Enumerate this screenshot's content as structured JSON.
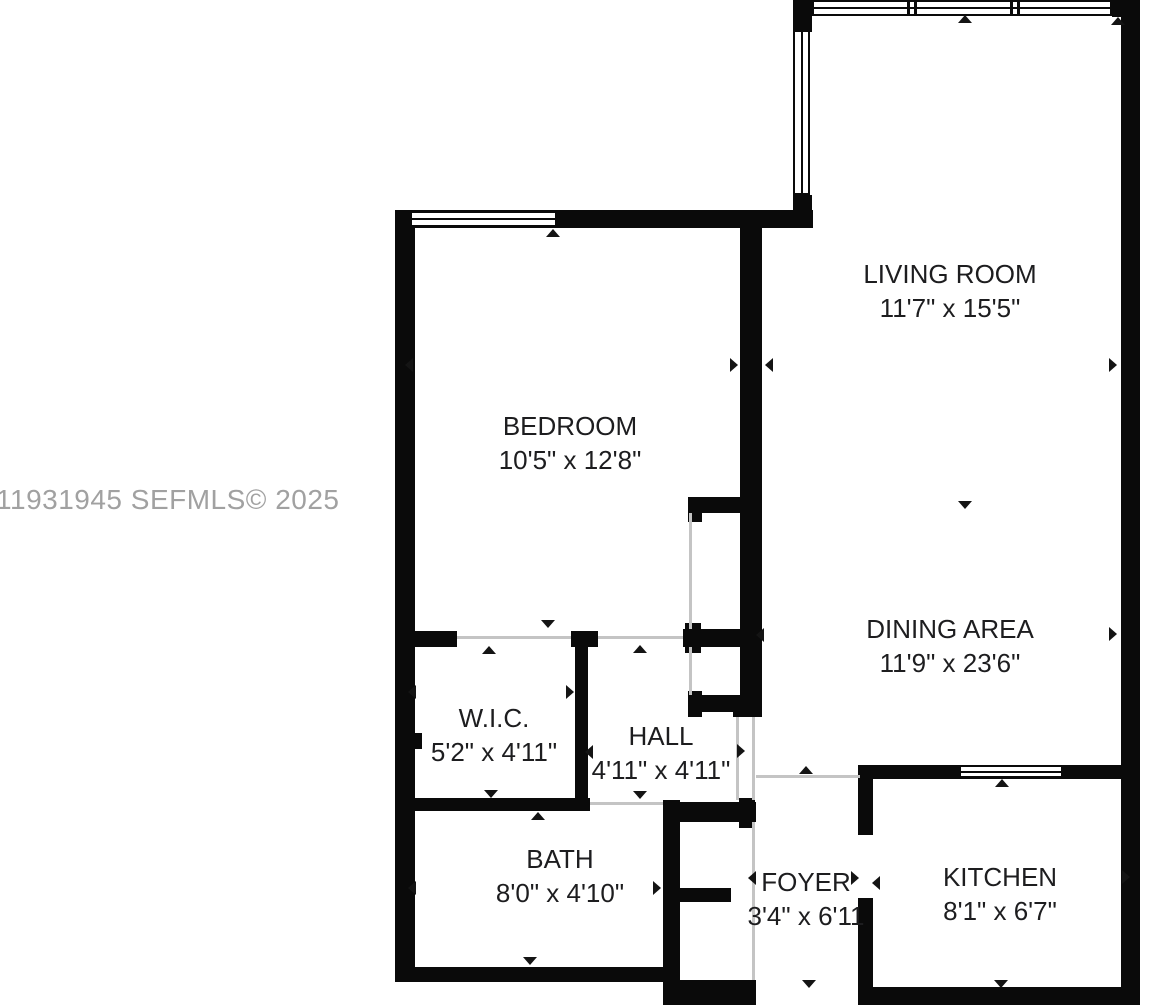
{
  "canvas": {
    "width": 1149,
    "height": 1005
  },
  "colors": {
    "wall": "#0a0a0a",
    "background": "#ffffff",
    "opening_line": "#c4c4c4",
    "label_text": "#1d1d1f",
    "watermark_text": "#a1a1a1"
  },
  "watermark": {
    "text": "11931945  SEFMLS© 2025"
  },
  "rooms": [
    {
      "id": "living-room",
      "name": "LIVING ROOM",
      "dims": "11'7\" x 15'5\"",
      "cx": 950,
      "cy": 291
    },
    {
      "id": "bedroom",
      "name": "BEDROOM",
      "dims": "10'5\" x 12'8\"",
      "cx": 570,
      "cy": 443
    },
    {
      "id": "dining-area",
      "name": "DINING AREA",
      "dims": "11'9\" x 23'6\"",
      "cx": 950,
      "cy": 646
    },
    {
      "id": "wic",
      "name": "W.I.C.",
      "dims": "5'2\" x 4'11\"",
      "cx": 494,
      "cy": 735
    },
    {
      "id": "hall",
      "name": "HALL",
      "dims": "4'11\" x 4'11\"",
      "cx": 661,
      "cy": 753
    },
    {
      "id": "bath",
      "name": "BATH",
      "dims": "8'0\" x 4'10\"",
      "cx": 560,
      "cy": 876
    },
    {
      "id": "foyer",
      "name": "FOYER",
      "dims": "3'4\" x 6'11",
      "cx": 806,
      "cy": 899
    },
    {
      "id": "kitchen",
      "name": "KITCHEN",
      "dims": "8'1\" x 6'7\"",
      "cx": 1000,
      "cy": 894
    }
  ],
  "geometry": {
    "walls": [
      {
        "x": 793,
        "y": 0,
        "w": 19,
        "h": 32
      },
      {
        "x": 1112,
        "y": 0,
        "w": 28,
        "h": 17
      },
      {
        "x": 1121,
        "y": 0,
        "w": 19,
        "h": 1005
      },
      {
        "x": 793,
        "y": 195,
        "w": 19,
        "h": 33
      },
      {
        "x": 395,
        "y": 210,
        "w": 418,
        "h": 18
      },
      {
        "x": 395,
        "y": 210,
        "w": 20,
        "h": 772
      },
      {
        "x": 740,
        "y": 228,
        "w": 22,
        "h": 489
      },
      {
        "x": 688,
        "y": 497,
        "w": 56,
        "h": 16
      },
      {
        "x": 688,
        "y": 497,
        "w": 14,
        "h": 25
      },
      {
        "x": 683,
        "y": 629,
        "w": 61,
        "h": 18
      },
      {
        "x": 685,
        "y": 623,
        "w": 16,
        "h": 30
      },
      {
        "x": 688,
        "y": 695,
        "w": 56,
        "h": 17
      },
      {
        "x": 688,
        "y": 691,
        "w": 14,
        "h": 26
      },
      {
        "x": 733,
        "y": 695,
        "w": 29,
        "h": 22
      },
      {
        "x": 408,
        "y": 631,
        "w": 49,
        "h": 16
      },
      {
        "x": 571,
        "y": 631,
        "w": 27,
        "h": 16
      },
      {
        "x": 575,
        "y": 646,
        "w": 13,
        "h": 154
      },
      {
        "x": 408,
        "y": 798,
        "w": 182,
        "h": 13
      },
      {
        "x": 415,
        "y": 733,
        "w": 7,
        "h": 16
      },
      {
        "x": 395,
        "y": 967,
        "w": 270,
        "h": 15
      },
      {
        "x": 663,
        "y": 800,
        "w": 17,
        "h": 205
      },
      {
        "x": 680,
        "y": 802,
        "w": 76,
        "h": 20
      },
      {
        "x": 739,
        "y": 798,
        "w": 16,
        "h": 30
      },
      {
        "x": 680,
        "y": 888,
        "w": 51,
        "h": 14
      },
      {
        "x": 663,
        "y": 980,
        "w": 93,
        "h": 25
      },
      {
        "x": 858,
        "y": 765,
        "w": 282,
        "h": 14
      },
      {
        "x": 858,
        "y": 765,
        "w": 15,
        "h": 70
      },
      {
        "x": 858,
        "y": 898,
        "w": 15,
        "h": 107
      },
      {
        "x": 858,
        "y": 987,
        "w": 282,
        "h": 18
      }
    ],
    "windows": [
      {
        "x": 812,
        "y": 0,
        "w": 300,
        "h": 16,
        "o": "h"
      },
      {
        "x": 793,
        "y": 30,
        "w": 17,
        "h": 165,
        "o": "v"
      },
      {
        "x": 410,
        "y": 211,
        "w": 147,
        "h": 16,
        "o": "h"
      },
      {
        "x": 959,
        "y": 765,
        "w": 104,
        "h": 13,
        "o": "h"
      }
    ],
    "mullions": [
      {
        "x": 907,
        "y": 1,
        "w": 3,
        "h": 14
      },
      {
        "x": 914,
        "y": 1,
        "w": 3,
        "h": 14
      },
      {
        "x": 1010,
        "y": 1,
        "w": 3,
        "h": 14
      },
      {
        "x": 1017,
        "y": 1,
        "w": 3,
        "h": 14
      }
    ],
    "openings": [
      {
        "x": 457,
        "y": 636,
        "w": 114,
        "h": 3
      },
      {
        "x": 598,
        "y": 636,
        "w": 85,
        "h": 3
      },
      {
        "x": 689,
        "y": 513,
        "w": 3,
        "h": 116
      },
      {
        "x": 689,
        "y": 647,
        "w": 3,
        "h": 48
      },
      {
        "x": 736,
        "y": 717,
        "w": 3,
        "h": 83
      },
      {
        "x": 752,
        "y": 717,
        "w": 3,
        "h": 83
      },
      {
        "x": 590,
        "y": 802,
        "w": 73,
        "h": 3
      },
      {
        "x": 752,
        "y": 822,
        "w": 3,
        "h": 158
      },
      {
        "x": 756,
        "y": 775,
        "w": 104,
        "h": 3
      }
    ],
    "arrows": [
      {
        "d": "up",
        "x": 553,
        "y": 233
      },
      {
        "d": "up",
        "x": 965,
        "y": 19
      },
      {
        "d": "up",
        "x": 1118,
        "y": 21
      },
      {
        "d": "up",
        "x": 489,
        "y": 650
      },
      {
        "d": "up",
        "x": 640,
        "y": 649
      },
      {
        "d": "up",
        "x": 538,
        "y": 816
      },
      {
        "d": "up",
        "x": 806,
        "y": 770
      },
      {
        "d": "up",
        "x": 1002,
        "y": 783
      },
      {
        "d": "down",
        "x": 548,
        "y": 624
      },
      {
        "d": "down",
        "x": 965,
        "y": 505
      },
      {
        "d": "down",
        "x": 491,
        "y": 794
      },
      {
        "d": "down",
        "x": 640,
        "y": 795
      },
      {
        "d": "down",
        "x": 530,
        "y": 961
      },
      {
        "d": "down",
        "x": 809,
        "y": 984
      },
      {
        "d": "down",
        "x": 1001,
        "y": 984
      },
      {
        "d": "left",
        "x": 409,
        "y": 365
      },
      {
        "d": "left",
        "x": 769,
        "y": 365
      },
      {
        "d": "left",
        "x": 760,
        "y": 635
      },
      {
        "d": "left",
        "x": 412,
        "y": 692
      },
      {
        "d": "left",
        "x": 589,
        "y": 752
      },
      {
        "d": "left",
        "x": 412,
        "y": 888
      },
      {
        "d": "left",
        "x": 752,
        "y": 878
      },
      {
        "d": "left",
        "x": 876,
        "y": 883
      },
      {
        "d": "right",
        "x": 734,
        "y": 365
      },
      {
        "d": "right",
        "x": 1113,
        "y": 365
      },
      {
        "d": "right",
        "x": 1113,
        "y": 634
      },
      {
        "d": "right",
        "x": 570,
        "y": 692
      },
      {
        "d": "right",
        "x": 741,
        "y": 751
      },
      {
        "d": "right",
        "x": 657,
        "y": 888
      },
      {
        "d": "right",
        "x": 855,
        "y": 878
      },
      {
        "d": "right",
        "x": 1126,
        "y": 877
      }
    ]
  }
}
